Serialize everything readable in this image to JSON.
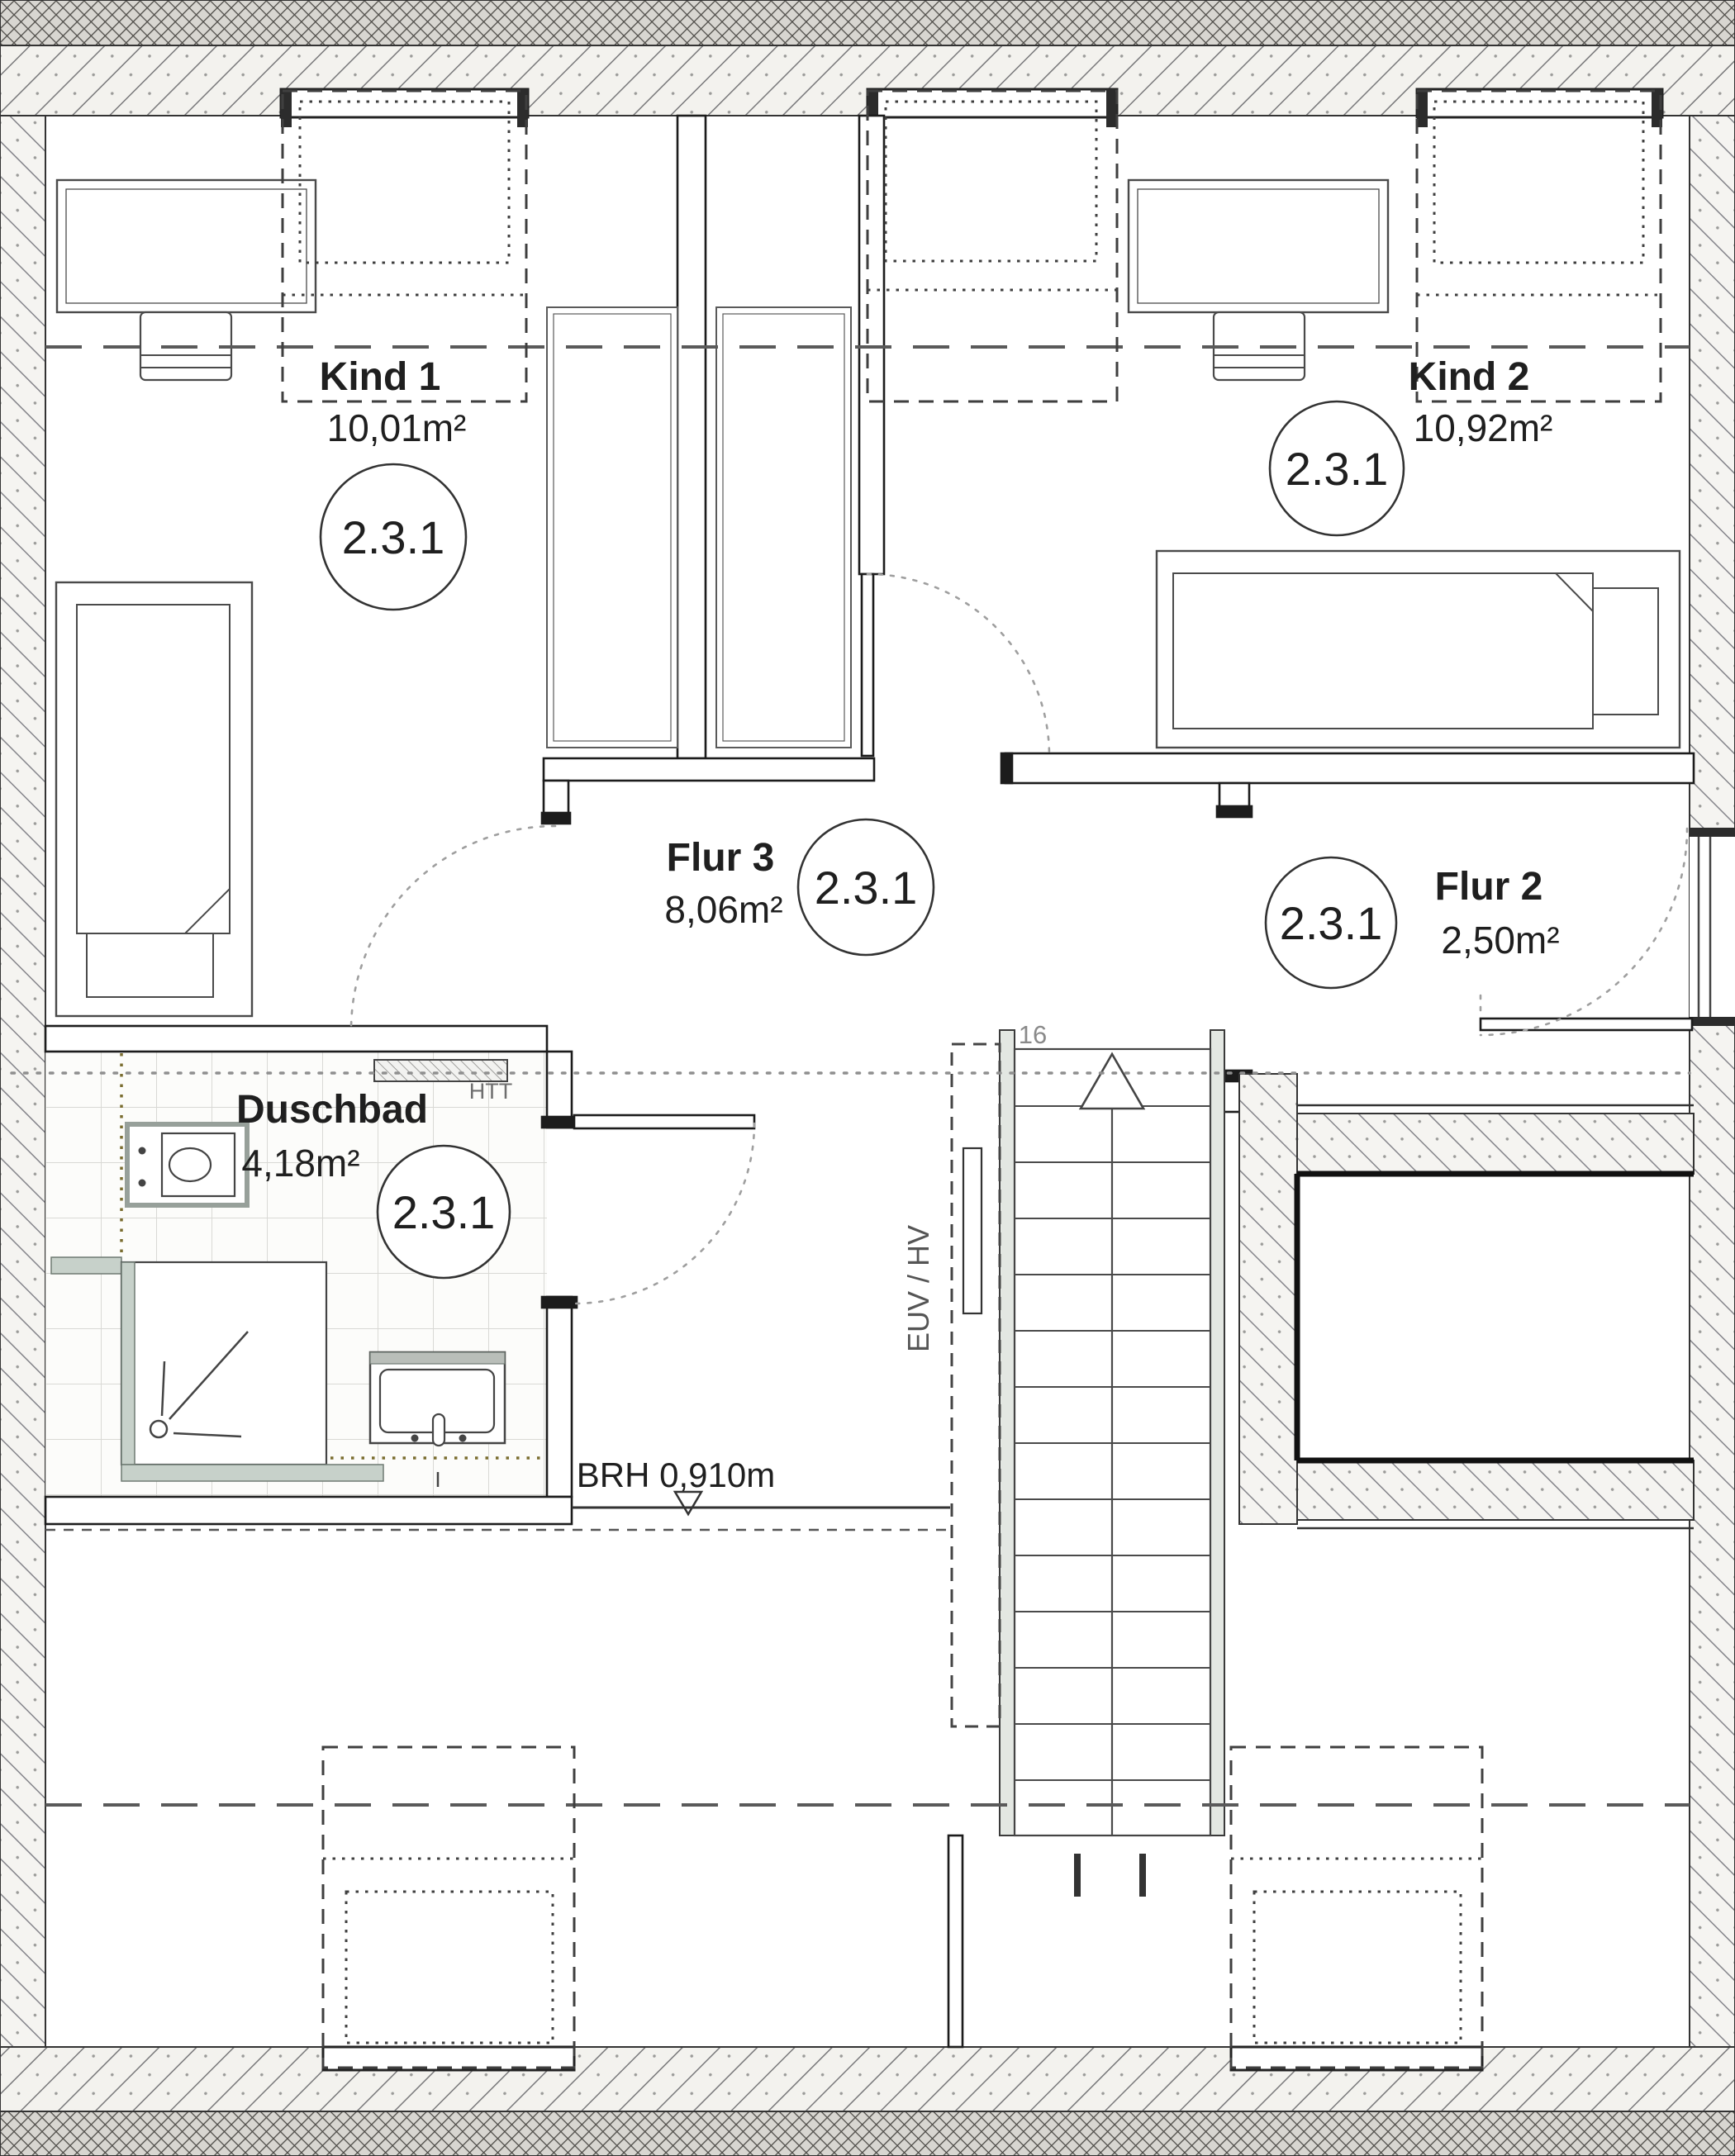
{
  "plan": {
    "rooms": [
      {
        "id": "kind1",
        "name": "Kind 1",
        "area": "10,01m²",
        "tag": "2.3.1"
      },
      {
        "id": "kind2",
        "name": "Kind 2",
        "area": "10,92m²",
        "tag": "2.3.1"
      },
      {
        "id": "flur3",
        "name": "Flur 3",
        "area": "8,06m²",
        "tag": "2.3.1"
      },
      {
        "id": "flur2",
        "name": "Flur 2",
        "area": "2,50m²",
        "tag": "2.3.1"
      },
      {
        "id": "duschbad",
        "name": "Duschbad",
        "area": "4,18m²",
        "tag": "2.3.1"
      }
    ],
    "annotations": {
      "sill_height": "BRH 0,910m",
      "stair_step_count": "16",
      "towel_radiator": "HTT",
      "utility_shaft": "EUV / HV"
    },
    "colors": {
      "line": "#2b2b2b",
      "hatch": "#8a8a88",
      "stair_wall": "#e3e7e2",
      "shower_frame": "#c7d1ca",
      "tile_line": "#d9d9d5",
      "tile_trim": "#7a6d2f"
    }
  }
}
